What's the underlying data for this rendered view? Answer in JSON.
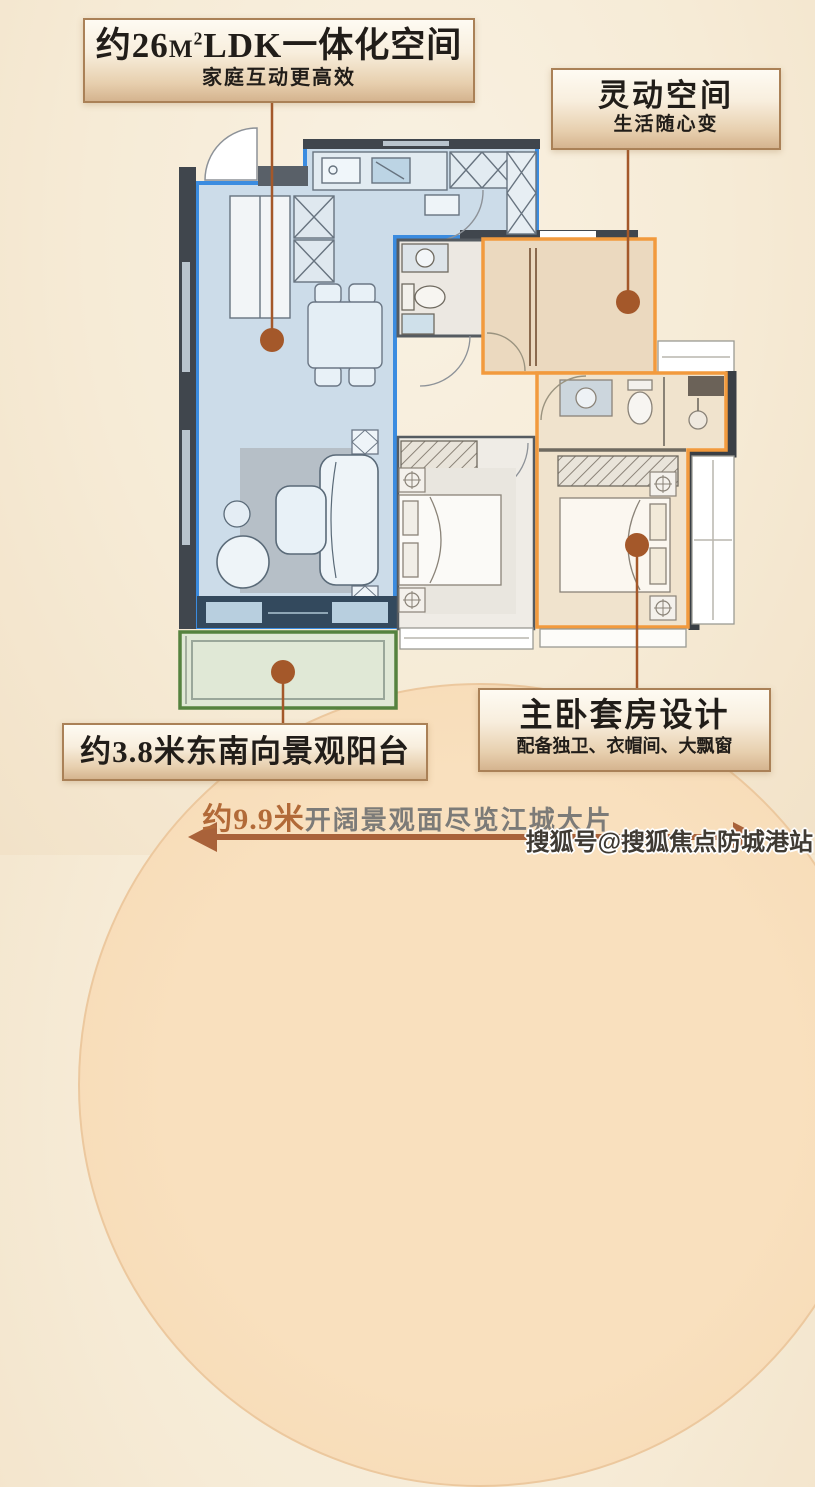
{
  "labels": {
    "ldk": {
      "title_prefix": "约26",
      "title_unit": "M",
      "title_sup": "2",
      "title_suffix": "LDK一体化空间",
      "subtitle": "家庭互动更高效"
    },
    "flex": {
      "title": "灵动空间",
      "subtitle": "生活随心变"
    },
    "balcony": {
      "title": "约3.8米东南向景观阳台"
    },
    "master": {
      "title": "主卧套房设计",
      "subtitle": "配备独卫、衣帽间、大飘窗"
    }
  },
  "bottom": {
    "highlight": "约9.9米",
    "text": "开阔景观面尽览江城大片"
  },
  "watermark": "搜狐号@搜狐焦点防城港站",
  "colors": {
    "ldk_region_blue": "#3b8ce0",
    "flex_region_orange": "#f29a3d",
    "balcony_region_green": "#55823f",
    "leader_line_brown": "#a4582a",
    "arrow_brown": "#a9623a"
  }
}
